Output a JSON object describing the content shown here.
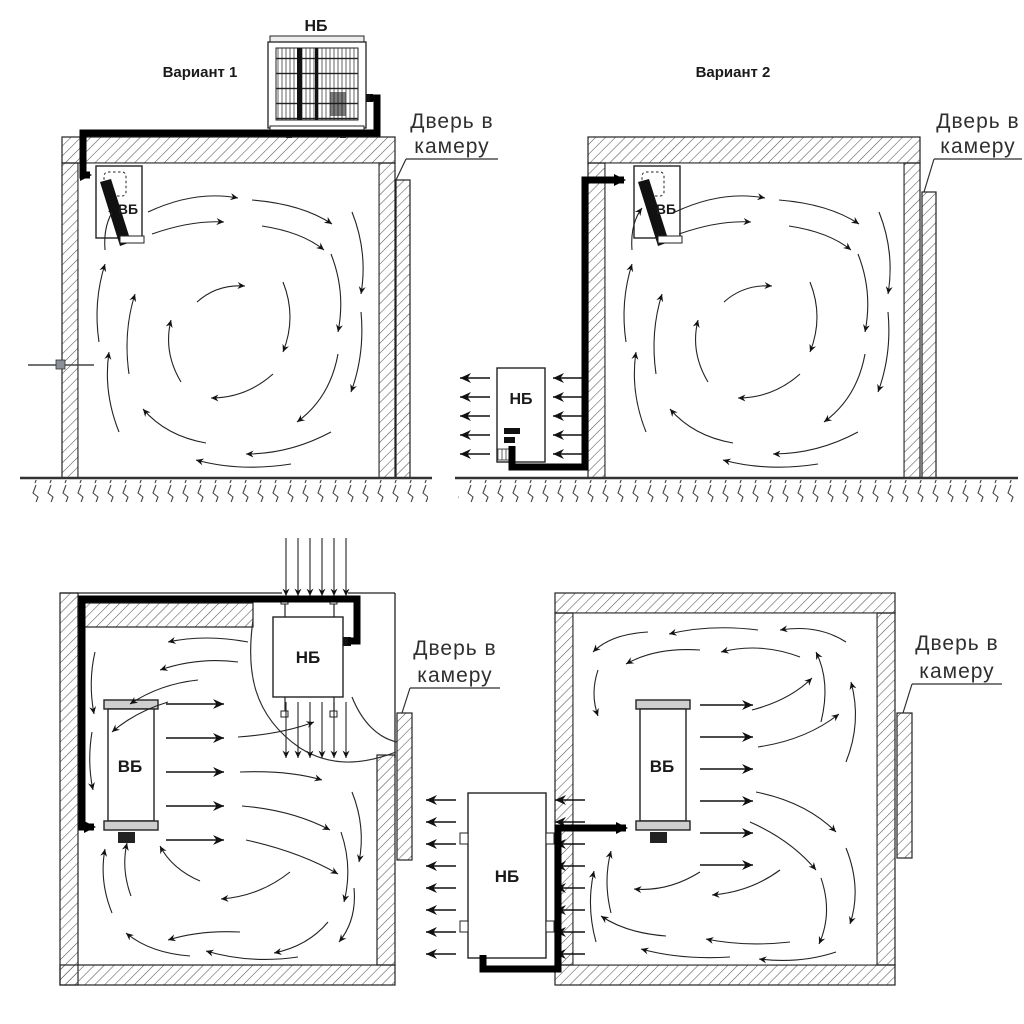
{
  "diagram_title": "Cold room split-system installation variants",
  "colors": {
    "ink": "#1a1a1a",
    "paper": "#ffffff",
    "pipe": "#000000",
    "hatch": "#555555"
  },
  "panels": [
    {
      "id": "variant-1",
      "title": "Вариант 1",
      "outdoor_unit": "НБ",
      "indoor_unit": "ВБ",
      "door_line1": "Дверь в",
      "door_line2": "камеру"
    },
    {
      "id": "variant-2",
      "title": "Вариант 2",
      "outdoor_unit": "НБ",
      "indoor_unit": "ВБ",
      "door_line1": "Дверь в",
      "door_line2": "камеру"
    },
    {
      "id": "variant-3",
      "title": "",
      "outdoor_unit": "НБ",
      "indoor_unit": "ВБ",
      "door_line1": "Дверь в",
      "door_line2": "камеру"
    },
    {
      "id": "variant-4",
      "title": "",
      "outdoor_unit": "НБ",
      "indoor_unit": "ВБ",
      "door_line1": "Дверь в",
      "door_line2": "камеру"
    }
  ]
}
